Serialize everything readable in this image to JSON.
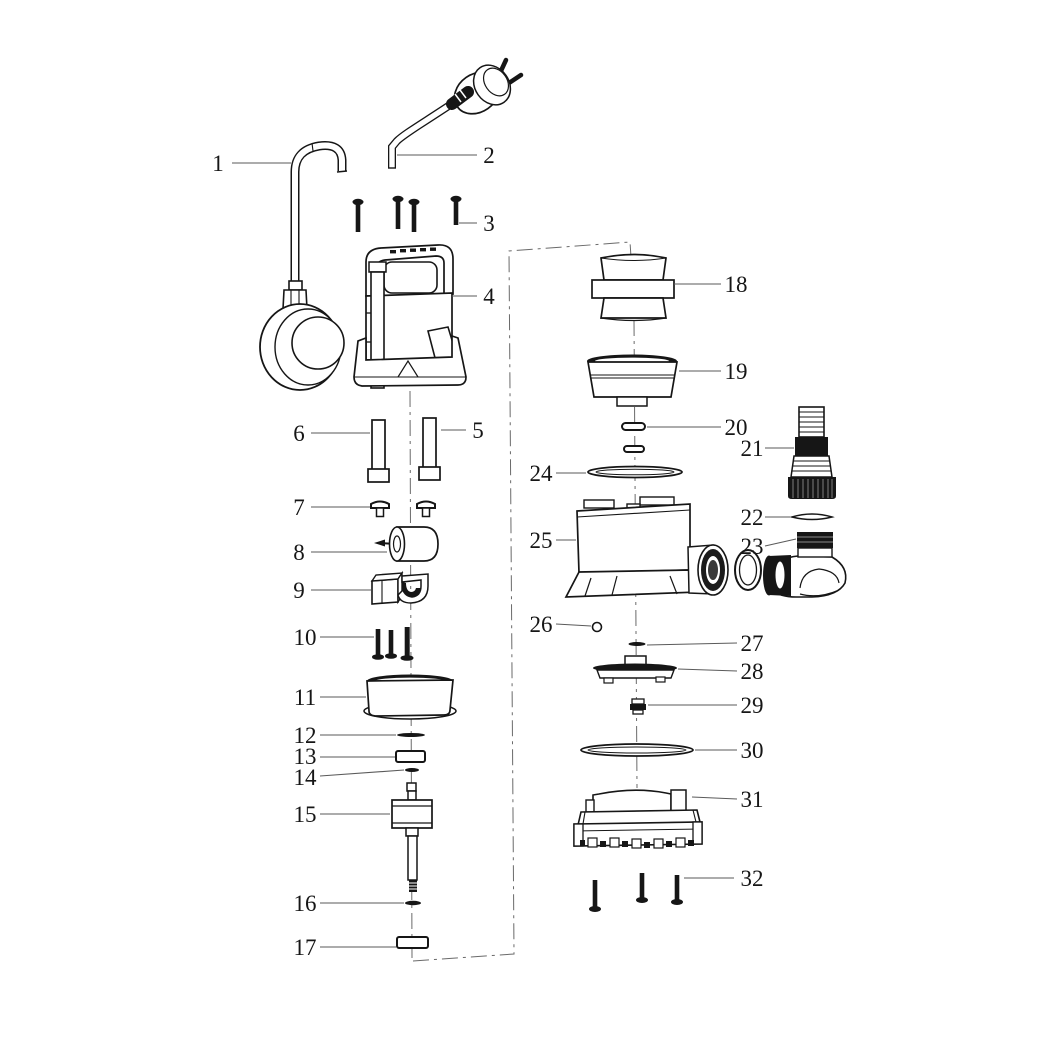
{
  "colors": {
    "background": "#ffffff",
    "ink": "#161616",
    "leader": "#5a5a5a",
    "centerline": "#6a6a6a"
  },
  "diagram": {
    "part_labels": [
      "1",
      "2",
      "3",
      "4",
      "5",
      "6",
      "7",
      "8",
      "9",
      "10",
      "11",
      "12",
      "13",
      "14",
      "15",
      "16",
      "17",
      "18",
      "19",
      "20",
      "21",
      "22",
      "23",
      "24",
      "25",
      "26",
      "27",
      "28",
      "29",
      "30",
      "31",
      "32"
    ]
  }
}
